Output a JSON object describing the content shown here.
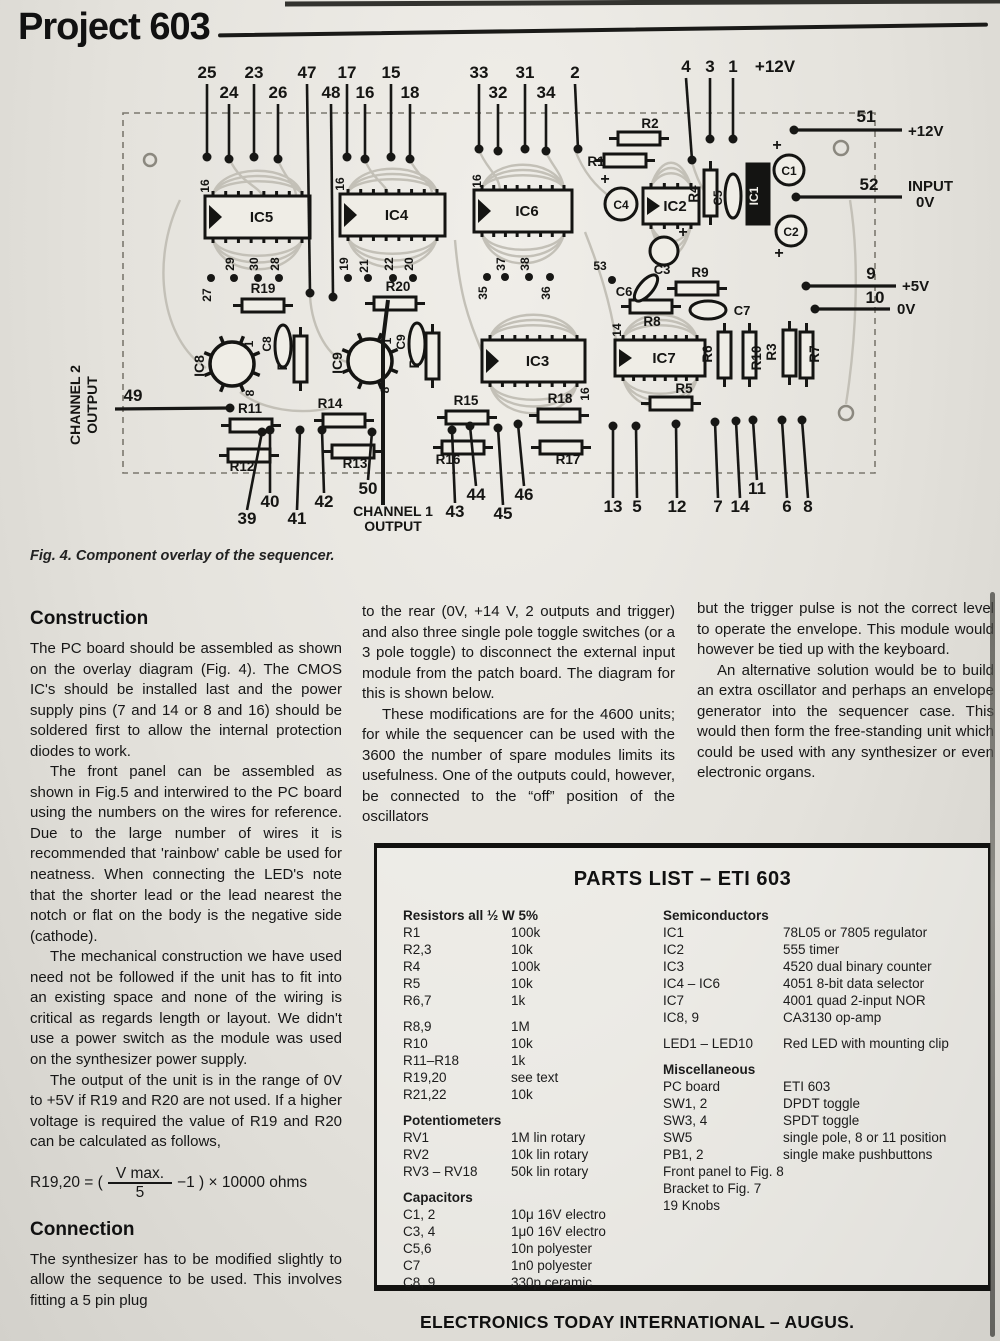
{
  "page": {
    "title": "Project 603",
    "caption": "Fig. 4. Component overlay of the sequencer.",
    "footer": "ELECTRONICS TODAY INTERNATIONAL – AUGUS."
  },
  "diagram": {
    "top_pins": [
      "25",
      "24",
      "23",
      "26",
      "47",
      "48",
      "17",
      "16",
      "15",
      "18",
      "33",
      "32",
      "31",
      "34",
      "2",
      "4",
      "3",
      "1",
      "+12V"
    ],
    "bottom_pins": [
      "39",
      "40",
      "41",
      "42",
      "50",
      "43",
      "44",
      "45",
      "46",
      "13",
      "5",
      "12",
      "7",
      "14",
      "11",
      "6",
      "8"
    ],
    "left_pin": "49",
    "channel_1_label": "CHANNEL 1 OUTPUT",
    "channel_2_label": "CHANNEL 2 OUTPUT",
    "right_connections": [
      {
        "pin": "51",
        "net": "+12V"
      },
      {
        "pin": "52",
        "net": "INPUT 0V"
      },
      {
        "pin": "9",
        "net": "+5V"
      },
      {
        "pin": "10",
        "net": "0V"
      }
    ],
    "ics": [
      "IC5",
      "IC4",
      "IC6",
      "IC3",
      "IC7",
      "IC2",
      "IC1",
      "IC8",
      "IC9"
    ],
    "resistors": [
      "R1",
      "R2",
      "R4",
      "R19",
      "R20",
      "R21",
      "R22",
      "R9",
      "R8",
      "R5",
      "R6",
      "R10",
      "R3",
      "R7",
      "R11",
      "R12",
      "R13",
      "R14",
      "R15",
      "R16",
      "R17",
      "R18"
    ],
    "capacitors": [
      "C1",
      "C2",
      "C3",
      "C4",
      "C5",
      "C6",
      "C7",
      "C8",
      "C9"
    ],
    "inner_pins": [
      "16",
      "16",
      "16",
      "27",
      "29",
      "30",
      "28",
      "19",
      "21",
      "22",
      "20",
      "35",
      "37",
      "38",
      "36",
      "53",
      "14",
      "16",
      "1",
      "8",
      "1",
      "8"
    ]
  },
  "article": {
    "construction_heading": "Construction",
    "construction_paragraphs": [
      "The PC board should be assembled as shown on the overlay diagram (Fig. 4). The CMOS IC's should be installed last and the power supply pins (7 and 14 or 8 and 16) should be soldered first to allow the internal protection diodes to work.",
      "The front panel can be assembled as shown in Fig.5 and interwired to the PC board using the numbers on the wires for reference. Due to the large number of wires it is recommended that 'rainbow' cable be used for neatness. When connecting the LED's note that the shorter lead or the lead nearest the notch or flat on the body is the negative side (cathode).",
      "The mechanical construction we have used need not be followed if the unit has to fit into an existing space and none of the wiring is critical as regards length or layout. We didn't use a power switch as the module was used on the synthesizer power supply.",
      "The output of the unit is in the range of 0V to +5V if R19 and R20 are not used. If a higher voltage is required the value of R19 and R20 can be calculated as follows,"
    ],
    "formula": {
      "lhs": "R19,20 = (",
      "numerator": "V max.",
      "denominator": "5",
      "rhs": "−1 ) × 10000 ohms"
    },
    "connection_heading": "Connection",
    "connection_paragraphs": [
      "The synthesizer has to be modified slightly to allow the sequence to be used. This involves fitting a 5 pin plug"
    ],
    "col2_paragraphs": [
      "to the rear (0V, +14 V, 2 outputs and trigger) and also three single pole toggle switches (or a 3 pole toggle) to disconnect the external input module from the patch board. The diagram for this is shown below.",
      "These modifications are for the 4600 units; for while the sequencer can be used with the 3600 the number of spare modules limits its usefulness. One of the outputs could, however, be connected to the “off” position of the oscillators"
    ],
    "col3_paragraphs": [
      "but the trigger pulse is not the correct level to operate the envelope. This module would however be tied up with the keyboard.",
      "An alternative solution would be to build an extra oscillator and perhaps an envelope generator into the sequencer case. This would then form the free-standing unit which could be used with any synthesizer or even electronic organs."
    ]
  },
  "parts_list": {
    "title": "PARTS LIST – ETI 603",
    "left_sections": [
      {
        "title": "Resistors all ½ W 5%",
        "rows": [
          [
            "R1",
            "100k"
          ],
          [
            "R2,3",
            "10k"
          ],
          [
            "R4",
            "100k"
          ],
          [
            "R5",
            "10k"
          ],
          [
            "R6,7",
            "1k"
          ]
        ]
      },
      {
        "title": "",
        "rows": [
          [
            "R8,9",
            "1M"
          ],
          [
            "R10",
            "10k"
          ],
          [
            "R11–R18",
            "1k"
          ],
          [
            "R19,20",
            "see text"
          ],
          [
            "R21,22",
            "10k"
          ]
        ]
      },
      {
        "title": "Potentiometers",
        "rows": [
          [
            "RV1",
            "1M lin rotary"
          ],
          [
            "RV2",
            "10k lin rotary"
          ],
          [
            "RV3 – RV18",
            "50k lin rotary"
          ]
        ]
      },
      {
        "title": "Capacitors",
        "rows": [
          [
            "C1, 2",
            "10μ 16V electro"
          ],
          [
            "C3, 4",
            "1μ0 16V electro"
          ],
          [
            "C5,6",
            "10n polyester"
          ],
          [
            "C7",
            "1n0 polyester"
          ],
          [
            "C8, 9",
            "330p ceramic"
          ]
        ]
      }
    ],
    "right_sections": [
      {
        "title": "Semiconductors",
        "rows": [
          [
            "IC1",
            "78L05 or 7805 regulator"
          ],
          [
            "IC2",
            "555 timer"
          ],
          [
            "IC3",
            "4520 dual binary counter"
          ],
          [
            "IC4 – IC6",
            "4051 8-bit data selector"
          ],
          [
            "IC7",
            "4001 quad 2-input NOR"
          ],
          [
            "IC8, 9",
            "CA3130 op-amp"
          ]
        ]
      },
      {
        "title": "",
        "rows": [
          [
            "LED1 – LED10",
            "Red LED with mounting clip"
          ]
        ]
      },
      {
        "title": "Miscellaneous",
        "rows": [
          [
            "PC board",
            "ETI 603"
          ],
          [
            "SW1, 2",
            "DPDT toggle"
          ],
          [
            "SW3, 4",
            "SPDT toggle"
          ],
          [
            "SW5",
            "single pole, 8 or 11 position"
          ],
          [
            "PB1, 2",
            "single make pushbuttons"
          ]
        ],
        "extra": [
          "Front panel to Fig. 8",
          "Bracket to Fig. 7",
          "19 Knobs"
        ]
      }
    ]
  }
}
